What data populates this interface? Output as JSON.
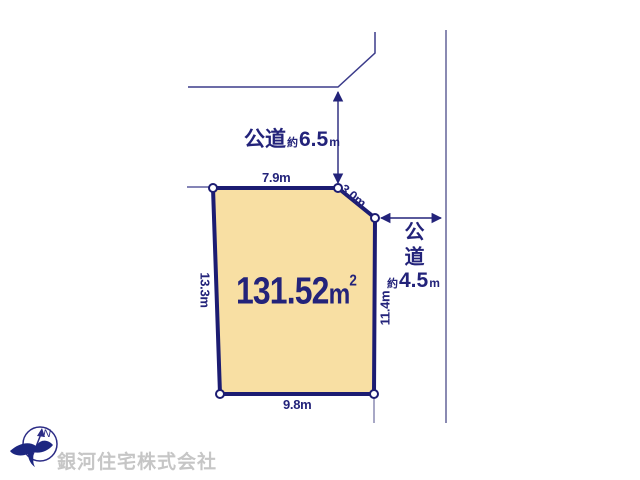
{
  "parcel": {
    "area_value": "131.52",
    "area_unit": "m",
    "area_exponent": "2",
    "fill_color": "#f8dfa3",
    "border_color": "#1c1c72",
    "dimensions": {
      "top": "7.9m",
      "diagonal": "3.0m",
      "left": "13.3m",
      "right": "11.4m",
      "bottom": "9.8m"
    }
  },
  "roads": {
    "top": {
      "name": "公道",
      "approx_prefix": "約",
      "width_value": "6.5",
      "width_unit": "m"
    },
    "right": {
      "name": "公道",
      "approx_prefix": "約",
      "width_value": "4.5",
      "width_unit": "m"
    }
  },
  "compass": {
    "north_label": "N"
  },
  "footer": {
    "company_name": "銀河住宅株式会社"
  },
  "colors": {
    "line_navy": "#23237a",
    "road_line_gray": "#8a8ab2",
    "watermark_gray": "#c6c6c6"
  }
}
